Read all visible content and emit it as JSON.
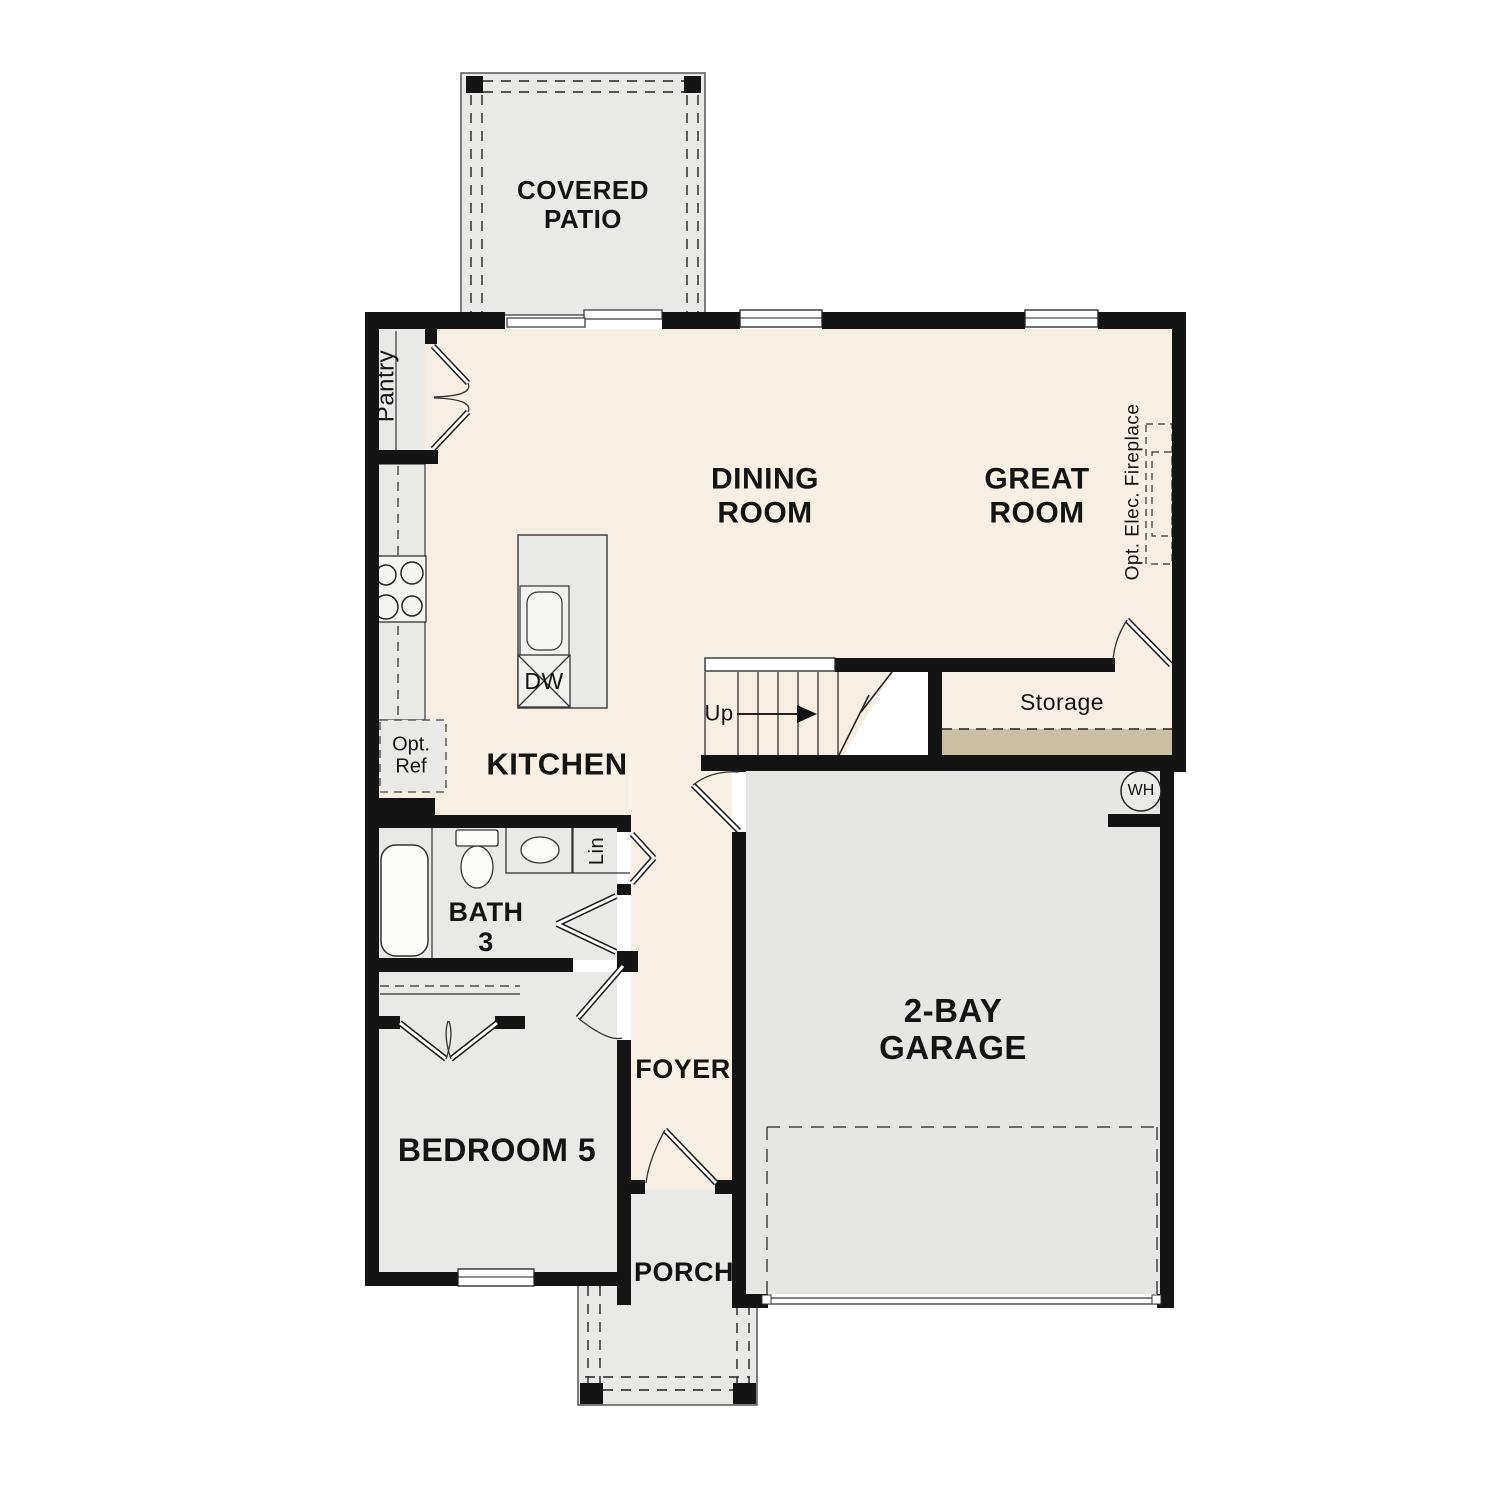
{
  "colors": {
    "floor": "#f7efe3",
    "room_gray": "#e9e9e8",
    "slab_gray": "#e6e6e5",
    "storage_tan": "#cbbfa5",
    "wall": "#141414"
  },
  "labels": {
    "covered_patio": "COVERED\nPATIO",
    "dining_room": "DINING\nROOM",
    "great_room": "GREAT\nROOM",
    "opt_elec_fireplace": "Opt. Elec. Fireplace",
    "pantry": "Pantry",
    "kitchen": "KITCHEN",
    "opt_ref": "Opt.\nRef",
    "dw": "DW",
    "up": "Up",
    "storage": "Storage",
    "wh": "WH",
    "bath3": "BATH\n3",
    "lin": "Lin",
    "bedroom5": "BEDROOM 5",
    "foyer": "FOYER",
    "porch": "PORCH",
    "garage": "2-BAY\nGARAGE"
  }
}
